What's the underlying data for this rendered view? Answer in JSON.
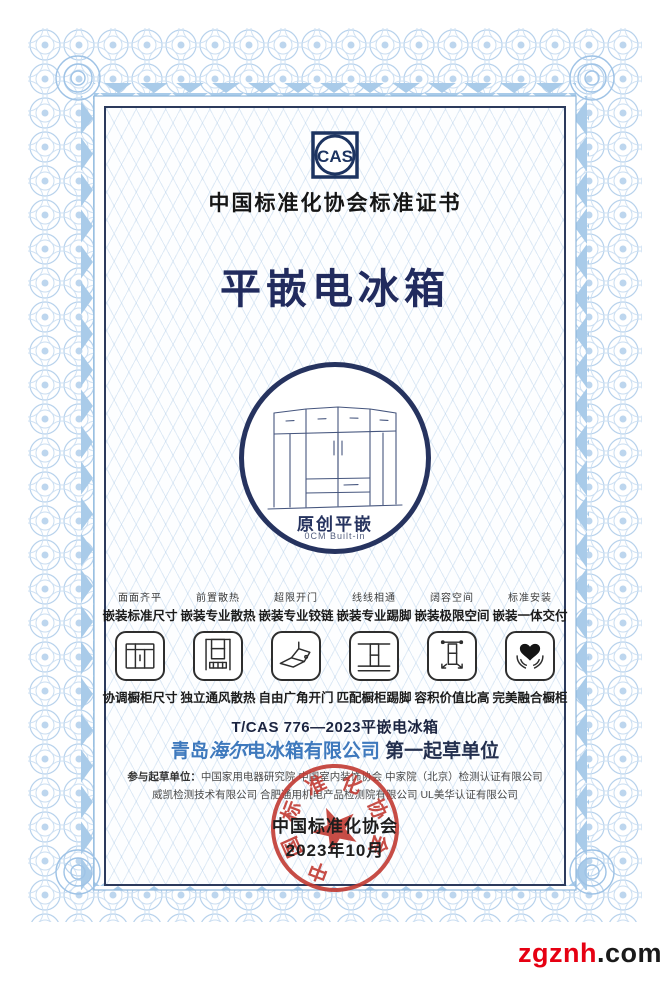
{
  "header": {
    "logo_text": "CAS",
    "certificate_title": "中国标准化协会标准证书"
  },
  "product": {
    "name": "平嵌电冰箱"
  },
  "emblem": {
    "brand": "原创平嵌",
    "subtitle": "0CM Built-in"
  },
  "features": [
    {
      "tagline": "面面齐平",
      "subtitle": "嵌装标准尺寸",
      "icon": "embed-standard-size-icon",
      "caption": "协调橱柜尺寸"
    },
    {
      "tagline": "前置散热",
      "subtitle": "嵌装专业散热",
      "icon": "front-ventilation-icon",
      "caption": "独立通风散热"
    },
    {
      "tagline": "超限开门",
      "subtitle": "嵌装专业铰链",
      "icon": "wide-angle-hinge-icon",
      "caption": "自由广角开门"
    },
    {
      "tagline": "线线相通",
      "subtitle": "嵌装专业踢脚",
      "icon": "plinth-match-icon",
      "caption": "匹配橱柜踢脚"
    },
    {
      "tagline": "阔容空间",
      "subtitle": "嵌装极限空间",
      "icon": "max-capacity-icon",
      "caption": "容积价值比高"
    },
    {
      "tagline": "标准安装",
      "subtitle": "嵌装一体交付",
      "icon": "heart-hands-icon",
      "caption": "完美融合橱柜"
    }
  ],
  "standard": {
    "code_line": "T/CAS 776—2023平嵌电冰箱",
    "company_prefix": "青岛",
    "company_brand": "海尔",
    "company_suffix": "电冰箱有限公司",
    "drafter_role": "第一起草单位",
    "participants_label": "参与起草单位：",
    "participants_line1": "中国家用电器研究院  中国室内装饰协会  中家院（北京）检测认证有限公司",
    "participants_line2": "威凯检测技术有限公司  合肥通用机电产品检测院有限公司  UL美华认证有限公司"
  },
  "issuer": {
    "name": "中国标准化协会",
    "date": "2023年10月",
    "seal_text": "中国标准化协会"
  },
  "watermark": {
    "site": "zgznh",
    "tld": ".com"
  },
  "colors": {
    "navy": "#222f5e",
    "company_blue": "#3e79bd",
    "seal_red": "#c23a32",
    "watermark_red": "#e60012",
    "border_blue": "#aecdea"
  }
}
